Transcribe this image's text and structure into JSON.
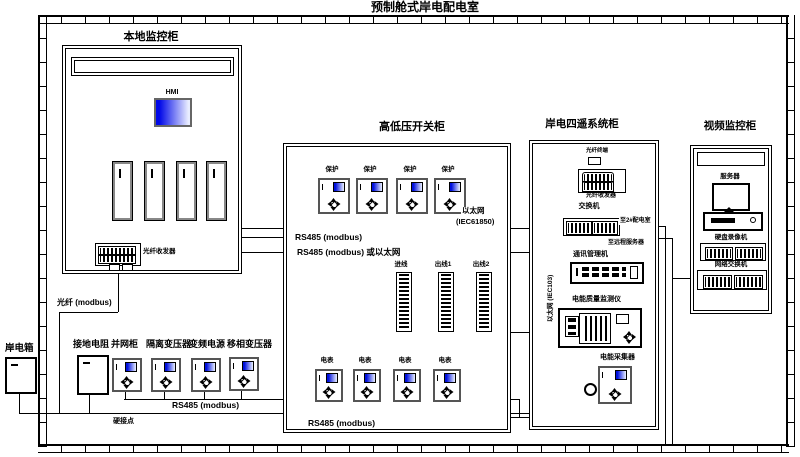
{
  "title": "预制舱式岸电配电室",
  "colors": {
    "screen_blue": "#0010dd",
    "line": "#000000"
  },
  "local_cabinet": {
    "label": "本地监控柜",
    "hmi_label": "HMI",
    "fiber_transceiver_label": "光纤收发器",
    "fiber_modbus_label": "光纤 (modbus)"
  },
  "shore_box": {
    "label": "岸电箱"
  },
  "bottom_row": {
    "device_labels": [
      "接地电阻",
      "并网柜",
      "隔离变压器",
      "变频电源",
      "移相变压器"
    ],
    "rs485_label": "RS485 (modbus)",
    "hard_contact_label": "硬接点"
  },
  "switchgear": {
    "label": "高低压开关柜",
    "relay_labels": [
      "保护",
      "保护",
      "保护",
      "保护"
    ],
    "ethernet_label": "以太网",
    "ethernet_std_label": "(IEC61850)",
    "rs485_bus_label": "RS485 (modbus)",
    "rs485_or_eth_label": "RS485 (modbus) 或以太网",
    "strip_labels": [
      "进线",
      "出线1",
      "出线2"
    ],
    "meter_labels": [
      "电表",
      "电表",
      "电表",
      "电表"
    ],
    "meter_rs485_label": "RS485 (modbus)"
  },
  "siyao_cabinet": {
    "label": "岸电四遥系统柜",
    "fiber_terminal_label": "光纤终端",
    "fiber_transceiver_label": "光纤收发器",
    "switch_label": "交换机",
    "to_room2_label": "至2#配电室",
    "to_remote_label": "至远程服务器",
    "eth_iec103_label": "以太网 (IEC103)",
    "comm_manager_label": "通讯管理机",
    "pq_monitor_label": "电能质量监测仪",
    "collector_label": "电能采集器"
  },
  "video_cabinet": {
    "label": "视频监控柜",
    "server_label": "服务器",
    "dvr_label": "硬盘录像机",
    "switch_label": "网络交换机"
  }
}
